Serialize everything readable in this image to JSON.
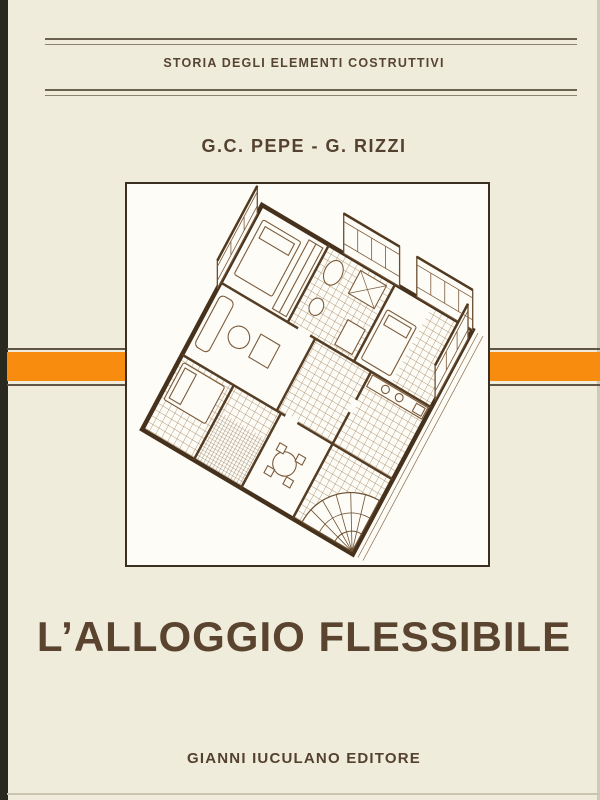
{
  "cover": {
    "series_title": "STORIA DEGLI ELEMENTI COSTRUTTIVI",
    "authors": "G.C. PEPE - G. RIZZI",
    "title": "L’ALLOGGIO FLESSIBILE",
    "publisher": "GIANNI IUCULANO EDITORE"
  },
  "illustration": {
    "description": "Axonometric cutaway drawing in brown ink of a furnished apartment floor plan with tiled rooms, beds, bathroom fixtures, a dense woven balcony panel and a fan-shaped staircase"
  },
  "colors": {
    "background_cream": "#EFECDB",
    "accent_orange": "#F78C0E",
    "text_brown": "#55412F",
    "title_brown": "#5A4430",
    "frame_border": "#3B2F21",
    "drawing_line": "#7B5A3B",
    "scan_edge": "#29281E"
  }
}
